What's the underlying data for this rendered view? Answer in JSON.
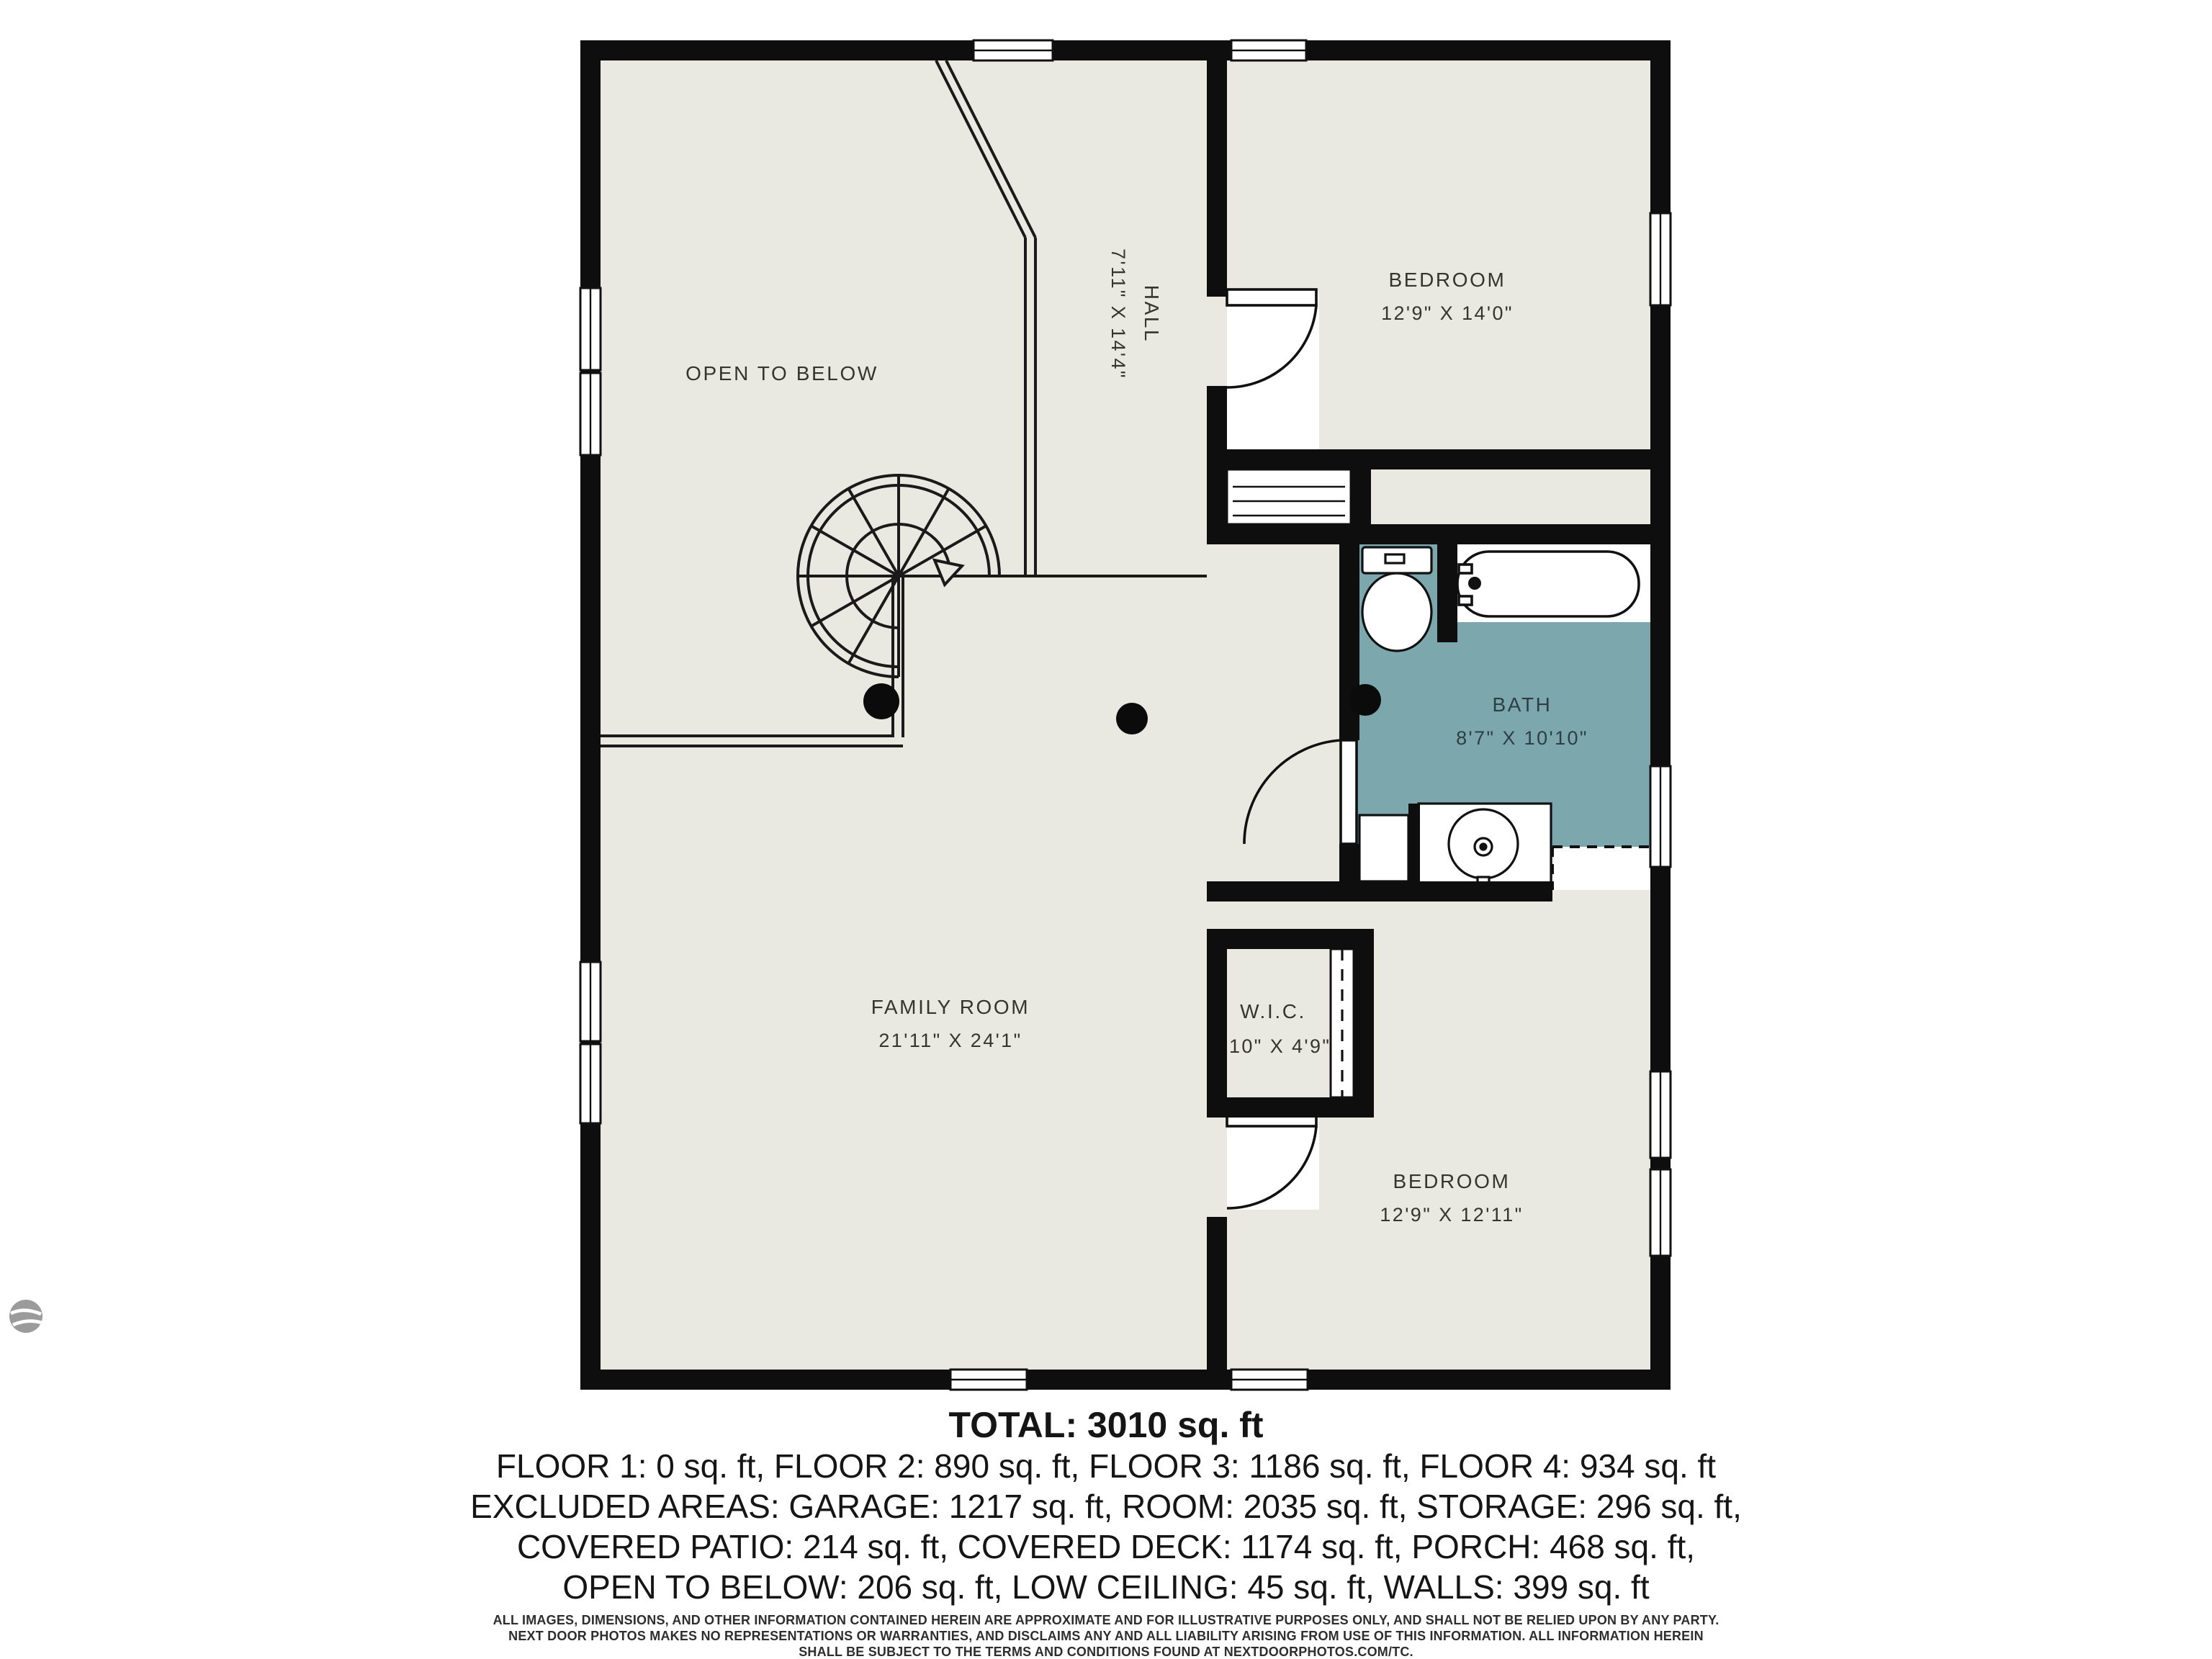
{
  "plan": {
    "colors": {
      "floor": "#EAE9E1",
      "wall": "#0E0E0E",
      "bath_fill": "#7CA7AC",
      "label": "#35352F"
    },
    "labels": {
      "open_to_below": {
        "name": "OPEN TO BELOW"
      },
      "hall": {
        "name": "HALL",
        "dims": "7'11\" X 14'4\""
      },
      "bedroom_top": {
        "name": "BEDROOM",
        "dims": "12'9\" X 14'0\""
      },
      "bath": {
        "name": "BATH",
        "dims": "8'7\" X 10'10\""
      },
      "wic": {
        "name": "W.I.C.",
        "dims": "3'10\" X 4'9\""
      },
      "family_room": {
        "name": "FAMILY ROOM",
        "dims": "21'11\" X 24'1\""
      },
      "bedroom_bottom": {
        "name": "BEDROOM",
        "dims": "12'9\" X 12'11\""
      }
    }
  },
  "summary": {
    "total": "TOTAL: 3010 sq. ft",
    "floors": "FLOOR 1: 0 sq. ft, FLOOR 2: 890 sq. ft, FLOOR 3: 1186 sq. ft, FLOOR 4: 934 sq. ft",
    "excluded1": "EXCLUDED AREAS: GARAGE: 1217 sq. ft, ROOM: 2035 sq. ft, STORAGE: 296 sq. ft,",
    "excluded2": "COVERED PATIO: 214 sq. ft, COVERED DECK: 1174 sq. ft, PORCH: 468 sq. ft,",
    "excluded3": "OPEN TO BELOW: 206 sq. ft, LOW CEILING: 45 sq. ft, WALLS: 399 sq. ft"
  },
  "disclaimer": {
    "line1": "ALL IMAGES, DIMENSIONS, AND OTHER INFORMATION CONTAINED HEREIN ARE APPROXIMATE AND FOR ILLUSTRATIVE PURPOSES ONLY, AND SHALL NOT BE RELIED UPON BY ANY PARTY.",
    "line2": "NEXT DOOR PHOTOS MAKES NO REPRESENTATIONS OR WARRANTIES, AND DISCLAIMS ANY AND ALL LIABILITY ARISING FROM USE OF THIS INFORMATION. ALL INFORMATION HEREIN",
    "line3": "SHALL BE SUBJECT TO THE TERMS AND CONDITIONS FOUND AT NEXTDOORPHOTOS.COM/TC."
  }
}
